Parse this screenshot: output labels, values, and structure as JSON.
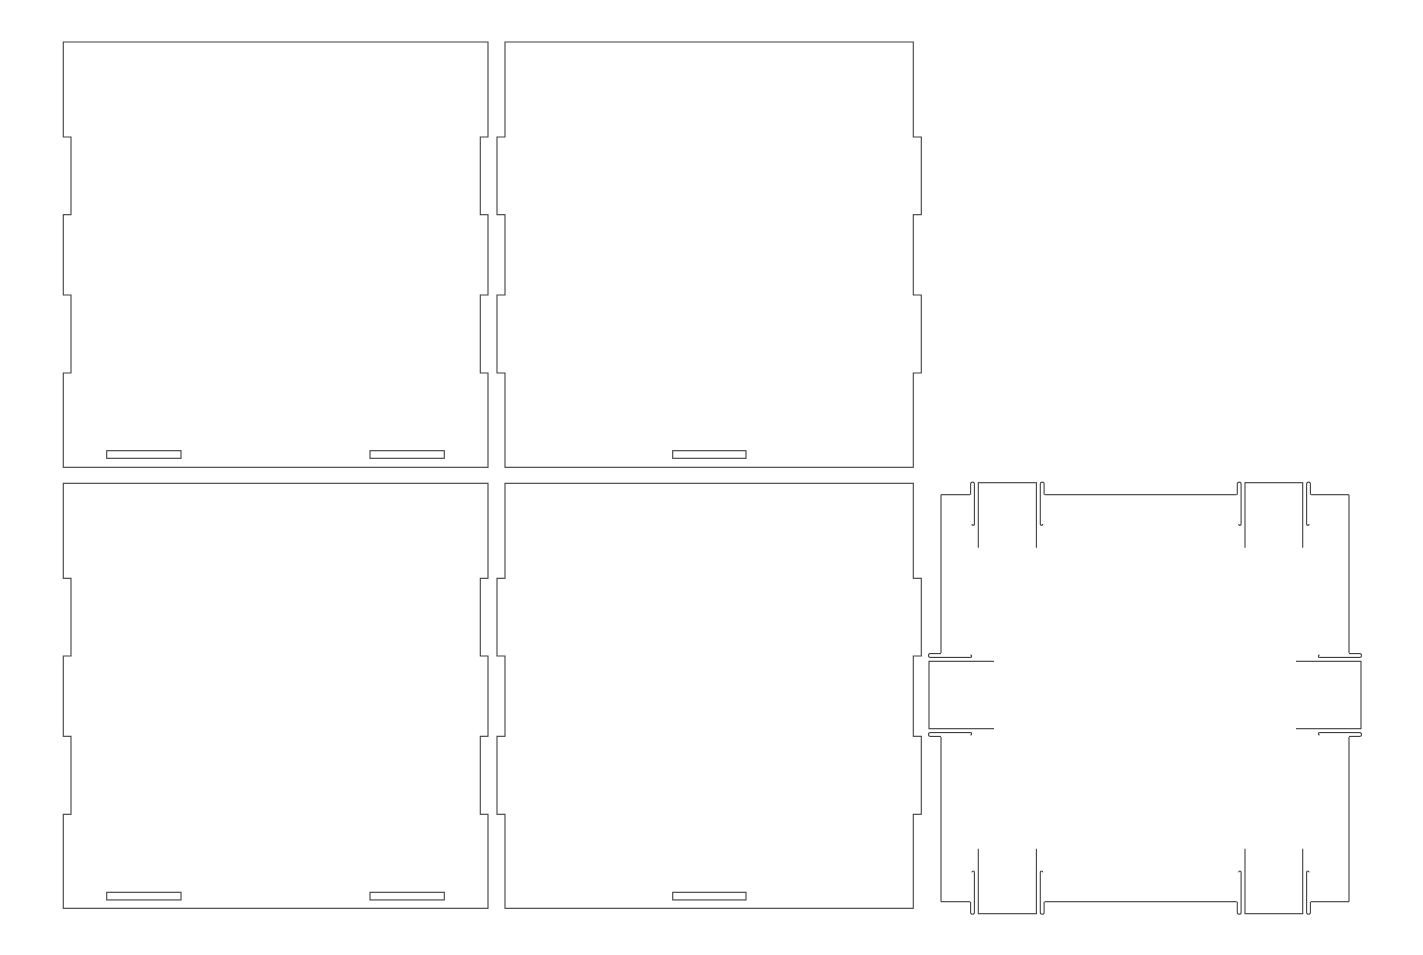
{
  "canvas": {
    "width": 1423,
    "height": 955,
    "background": "#ffffff",
    "line_color": "#3f3f3f",
    "line_width": 1.1
  },
  "template": {
    "kind": "laser-cut-box-panels",
    "material_thickness_px": 8
  },
  "panels": [
    {
      "id": "wall-top-left",
      "outline": {
        "x": 63.3,
        "y": 42,
        "width": 424.7,
        "height": 425.3
      },
      "left_edge": {
        "style": "notch",
        "depth": 7.7,
        "spans": [
          [
            95,
            172.7
          ],
          [
            253,
            331
          ]
        ]
      },
      "right_edge": {
        "style": "notch",
        "depth": 7.7,
        "spans": [
          [
            95,
            172.7
          ],
          [
            253,
            331
          ]
        ]
      },
      "slots": [
        {
          "x": 43.4,
          "y": 408.7,
          "width": 74.3,
          "height": 7.6
        },
        {
          "x": 306.7,
          "y": 408.7,
          "width": 74.3,
          "height": 7.6
        }
      ]
    },
    {
      "id": "wall-top-middle",
      "outline": {
        "x": 505,
        "y": 42,
        "width": 408.3,
        "height": 425.3
      },
      "left_edge": {
        "style": "tab",
        "depth": 8,
        "spans": [
          [
            95,
            172.7
          ],
          [
            253,
            331
          ]
        ]
      },
      "right_edge": {
        "style": "tab",
        "depth": 8,
        "spans": [
          [
            95,
            172.7
          ],
          [
            253,
            331
          ]
        ]
      },
      "slots": [
        {
          "x": 167.7,
          "y": 408.7,
          "width": 73.3,
          "height": 7.6
        }
      ]
    },
    {
      "id": "wall-bottom-left",
      "outline": {
        "x": 63.3,
        "y": 483.3,
        "width": 424.7,
        "height": 425
      },
      "left_edge": {
        "style": "notch",
        "depth": 7.7,
        "spans": [
          [
            95,
            172.7
          ],
          [
            253,
            331
          ]
        ]
      },
      "right_edge": {
        "style": "notch",
        "depth": 7.7,
        "spans": [
          [
            95,
            172.7
          ],
          [
            253,
            331
          ]
        ]
      },
      "slots": [
        {
          "x": 43.4,
          "y": 409,
          "width": 74.3,
          "height": 7.6
        },
        {
          "x": 306.7,
          "y": 409,
          "width": 74.3,
          "height": 7.6
        }
      ]
    },
    {
      "id": "wall-bottom-middle",
      "outline": {
        "x": 505,
        "y": 483.3,
        "width": 408.3,
        "height": 425
      },
      "left_edge": {
        "style": "tab",
        "depth": 8,
        "spans": [
          [
            95,
            172.7
          ],
          [
            253,
            331
          ]
        ]
      },
      "right_edge": {
        "style": "tab",
        "depth": 8,
        "spans": [
          [
            95,
            172.7
          ],
          [
            253,
            331
          ]
        ]
      },
      "slots": [
        {
          "x": 167.7,
          "y": 409,
          "width": 73.3,
          "height": 7.6
        }
      ]
    }
  ],
  "lid": {
    "id": "lid-click-on",
    "outline": {
      "x": 941,
      "y": 494.7,
      "width": 408,
      "height": 407
    },
    "clip_geometry": {
      "hook_inset": 0.6,
      "hook_rise": 10.4,
      "hook_apex": 13.2,
      "hook_line_inset": 4.4,
      "hook_depth": 29.3,
      "hook_tip_offset": 2.0,
      "tab_inset": 8.3,
      "tab_height": 12,
      "tab_depth": 53
    },
    "clips": [
      {
        "edge": "top",
        "s": 29,
        "width": 74.7
      },
      {
        "edge": "top",
        "s": 295.7,
        "width": 74.3
      },
      {
        "edge": "bottom",
        "s": 29,
        "width": 74.7
      },
      {
        "edge": "bottom",
        "s": 295.7,
        "width": 74.3
      },
      {
        "edge": "left",
        "s": 158.3,
        "width": 84
      },
      {
        "edge": "right",
        "s": 158.3,
        "width": 84
      }
    ]
  }
}
